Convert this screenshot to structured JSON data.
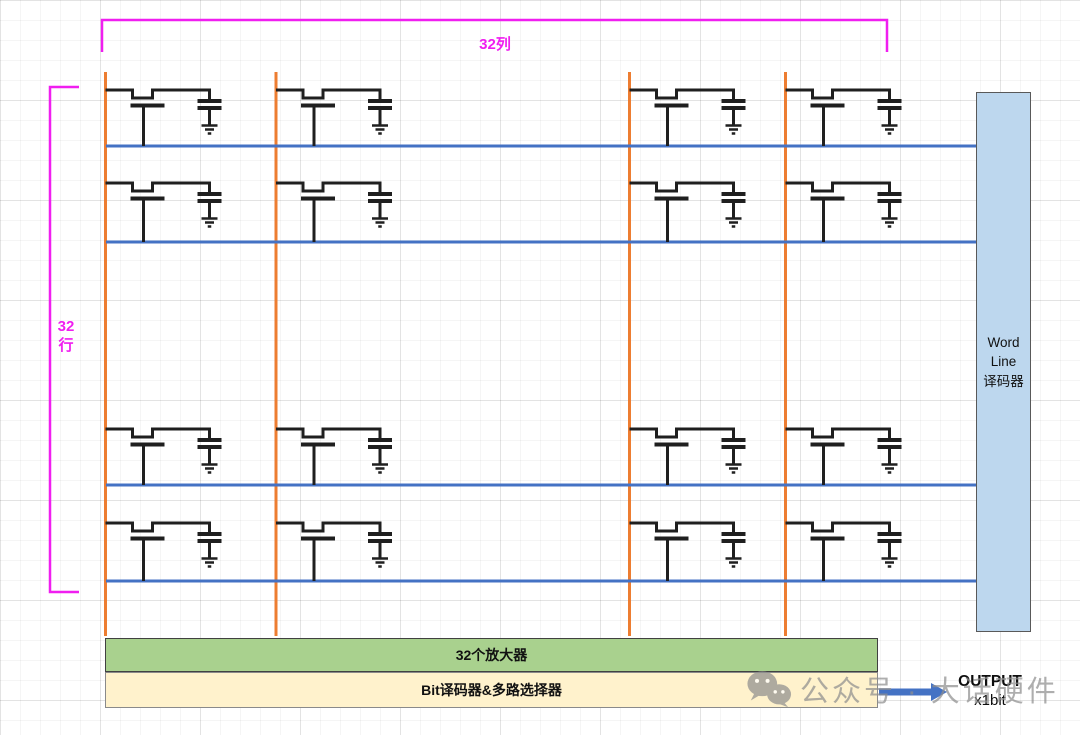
{
  "labels": {
    "columns": "32列",
    "rows_lines": [
      "32",
      "行"
    ]
  },
  "decoder_box": {
    "lines": [
      "Word",
      "Line",
      "译码器"
    ],
    "fill": "#BDD7EE",
    "border": "#595959"
  },
  "bars": {
    "amplifier": {
      "label": "32个放大器",
      "fill": "#A9D18E"
    },
    "bit_decoder": {
      "label": "Bit译码器&多路选择器",
      "fill": "#FFF2CC"
    }
  },
  "output": {
    "line1": "OUTPUT",
    "line2": "x1bit"
  },
  "watermark": {
    "icon": "wechat-icon",
    "text": "公众号 · 大话硬件",
    "color": "#8f8f8f"
  },
  "circuit": {
    "colors": {
      "bitline": "#ED7D31",
      "wordline": "#4472C4",
      "cell": "#1f1f1f",
      "bracket": "#F01EF0",
      "arrow": "#4472C4"
    },
    "bitlines_x": [
      105.5,
      276,
      629.5,
      785.5
    ],
    "bitline_top": 72,
    "bitline_bottom": 636,
    "wordline_x1": 106,
    "wordline_x2": 976,
    "rows": [
      {
        "wire_y": 90,
        "word_y": 146
      },
      {
        "wire_y": 183,
        "word_y": 242
      },
      {
        "wire_y": 429,
        "word_y": 485
      },
      {
        "wire_y": 523,
        "word_y": 581
      }
    ],
    "cell": {
      "notch_x1": 27,
      "notch_x2": 47,
      "notch_depth": 8,
      "gate_x1": 25,
      "gate_x2": 59,
      "gate_y": 15.5,
      "stem_x": 38,
      "cap_x": 104,
      "cap_plate_half": 12,
      "cap_top_y": 11,
      "cap_bot_y": 18,
      "gnd_top_y": 35,
      "gnd_widths": [
        16,
        9,
        3.5
      ]
    },
    "brackets": {
      "top": {
        "x1": 102,
        "x2": 887,
        "y": 20,
        "tick": 32
      },
      "left": {
        "x": 50,
        "y1": 87,
        "y2": 592,
        "tick": 29
      }
    },
    "arrow": {
      "x1": 879,
      "x2": 947,
      "y": 692,
      "shaft_w": 7,
      "head_l": 16,
      "head_w": 18
    }
  }
}
